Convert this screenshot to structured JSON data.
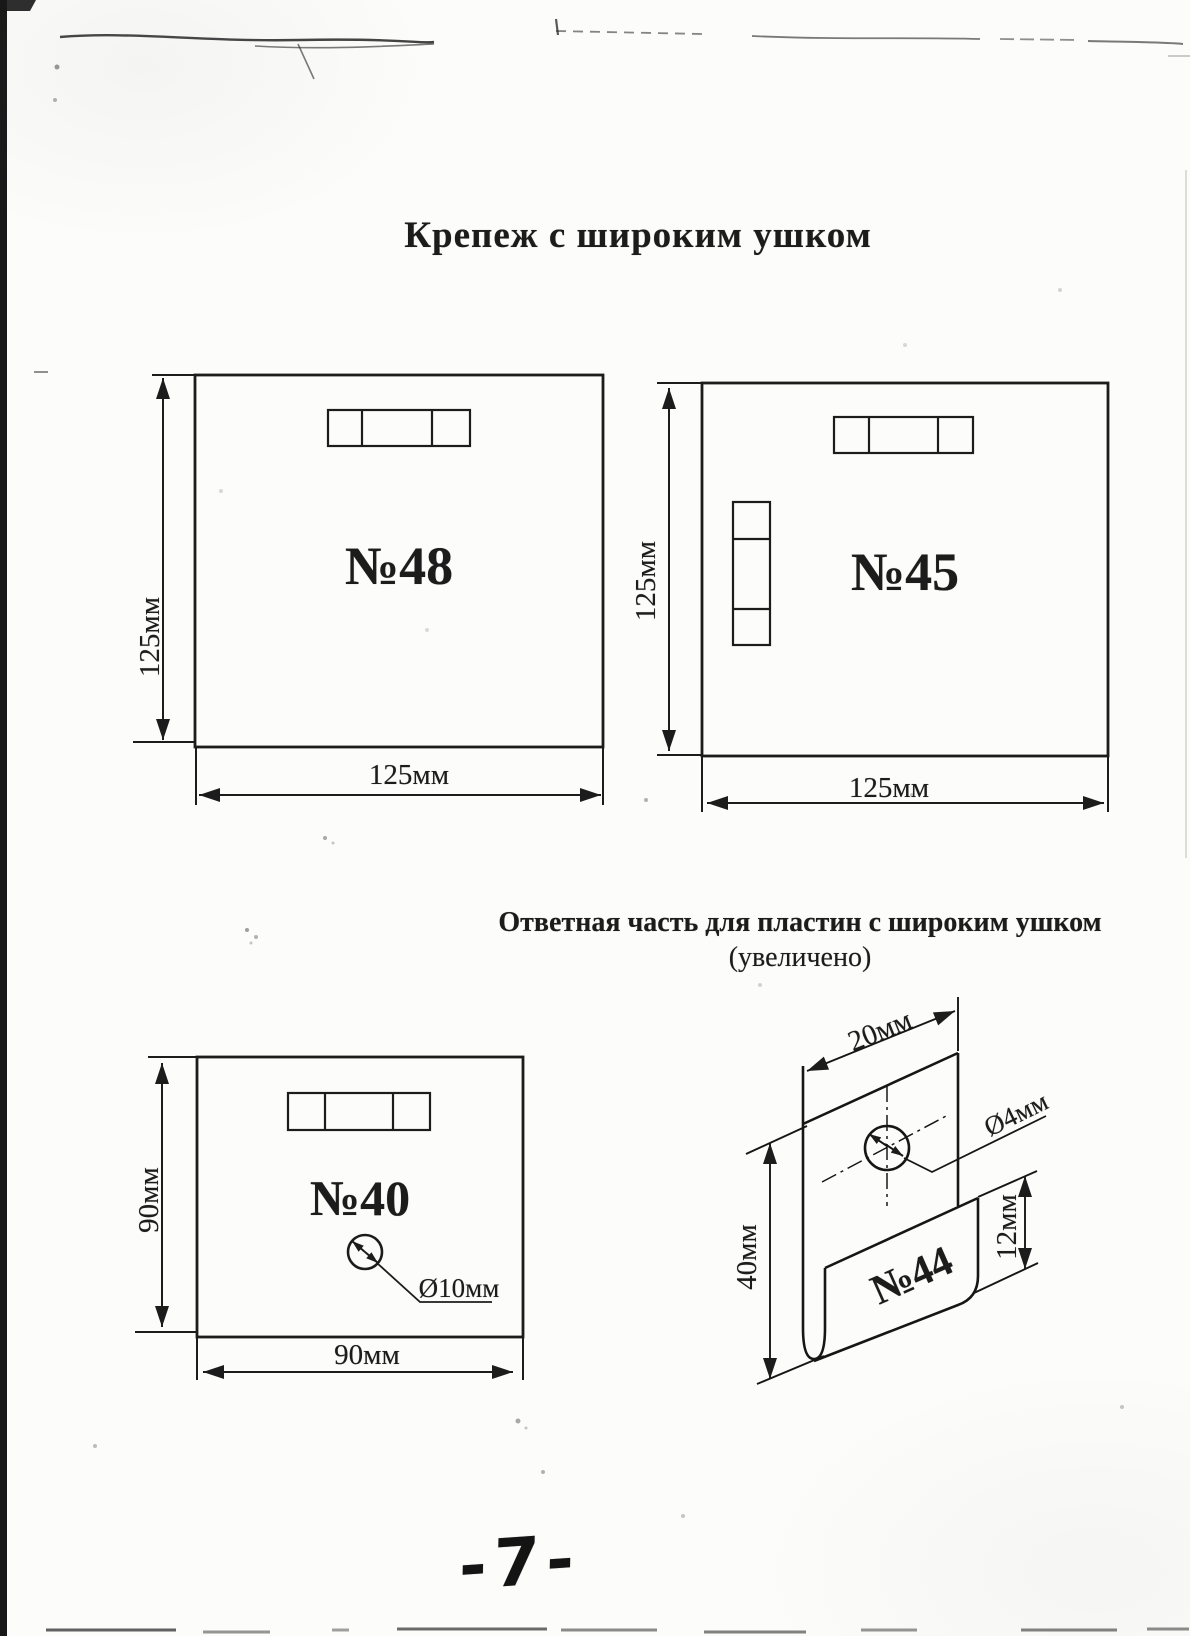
{
  "page": {
    "title": "Крепеж с широким ушком",
    "subtitle": "Ответная часть для пластин с широким ушком",
    "subtitle_note": "(увеличено)",
    "page_number": "-7-"
  },
  "figures": {
    "plate_48": {
      "label": "№48",
      "height_dim": "125мм",
      "width_dim": "125мм"
    },
    "plate_45": {
      "label": "№45",
      "height_dim": "125мм",
      "width_dim": "125мм"
    },
    "plate_40": {
      "label": "№40",
      "height_dim": "90мм",
      "width_dim": "90мм",
      "hole_dia": "Ø10мм"
    },
    "hook_44": {
      "label": "№44",
      "width_dim": "20мм",
      "height_dim": "40мм",
      "lip_height_dim": "12мм",
      "hole_dia": "Ø4мм"
    }
  },
  "colors": {
    "ink": "#1c1c1c",
    "paper": "#fcfcfa"
  }
}
